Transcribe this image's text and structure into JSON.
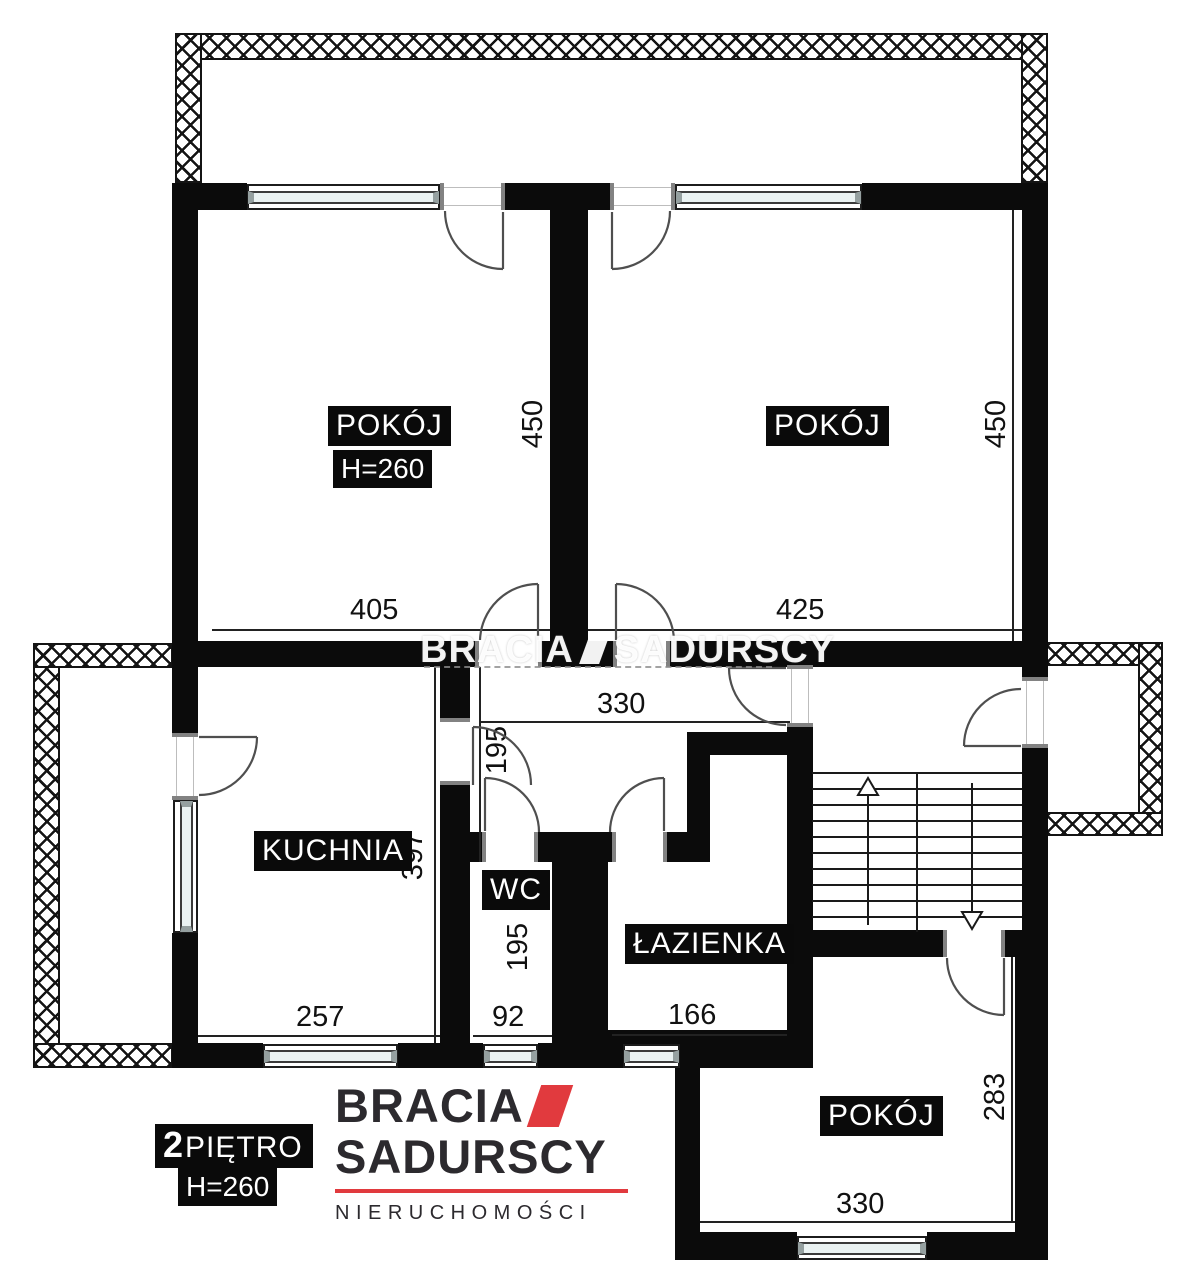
{
  "floor_plan": {
    "watermark": {
      "word1": "BRACIA",
      "word2": "SADURSCY"
    },
    "labels": {
      "room": "POKÓJ",
      "kitchen": "KUCHNIA",
      "wc": "WC",
      "bathroom": "ŁAZIENKA",
      "ceiling_height": "H=260"
    },
    "floor_badge": {
      "number": "2",
      "word": "PIĘTRO",
      "ceiling_height": "H=260"
    },
    "dimensions": {
      "room_tl_width": "405",
      "room_tl_depth": "450",
      "room_tr_width": "425",
      "room_tr_depth": "450",
      "hall_width": "330",
      "hall_entry_depth": "195",
      "kitchen_width": "257",
      "kitchen_depth": "397",
      "wc_width": "92",
      "wc_depth": "195",
      "bathroom_width": "166",
      "room_b_width": "330",
      "room_b_depth": "283"
    },
    "logo": {
      "line1": "BRACIA",
      "line2": "SADURSCY",
      "line3": "NIERUCHOMOŚCI"
    },
    "colors": {
      "wall": "#0b0b0b",
      "accent_red": "#e13a3e",
      "glass": "#eaf2f2"
    }
  }
}
